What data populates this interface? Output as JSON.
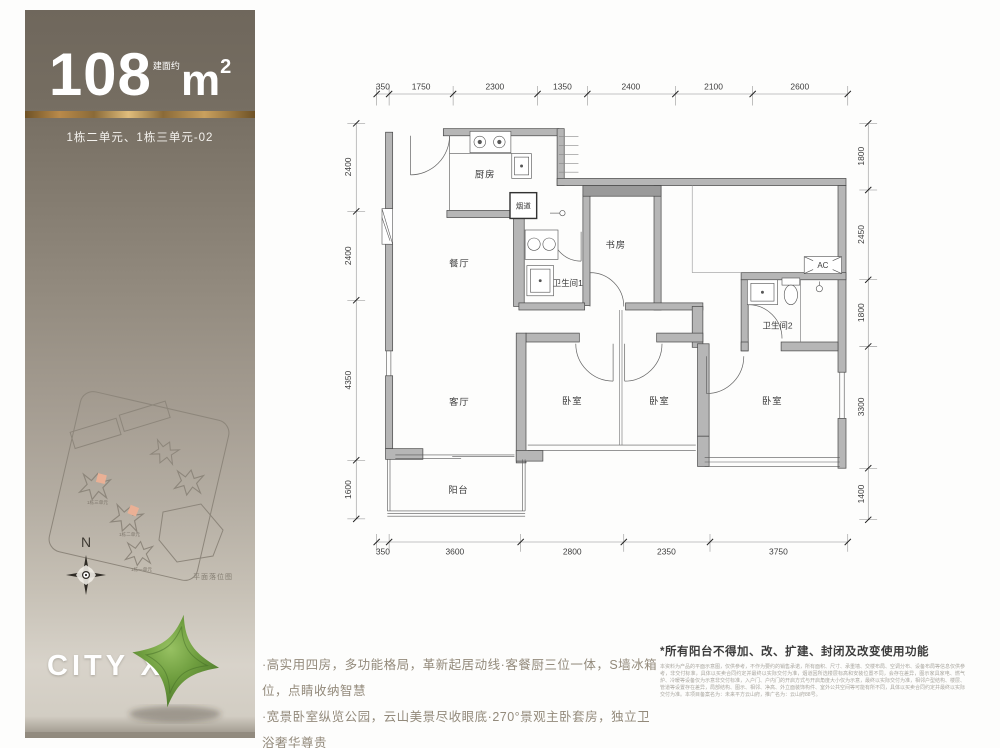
{
  "sidebar": {
    "area_value": "108",
    "area_prefix": "建面约",
    "area_unit": "m",
    "area_sup": "2",
    "unit_line": "1栋二单元、1栋三单元-02",
    "compass_label": "N",
    "siteplan_caption": "平面落位图",
    "siteplan_buildings": [
      "1栋三单元",
      "1栋二单元",
      "1栋一单元"
    ],
    "logo_text": "CITY X",
    "accent_gold": "#b98a4a",
    "logo_green": "#6f9e3f"
  },
  "floorplan": {
    "rooms": {
      "kitchen": "厨房",
      "flue": "烟道",
      "dining": "餐厅",
      "bath1": "卫生间1",
      "study": "书房",
      "ac": "AC",
      "bath2": "卫生间2",
      "living": "客厅",
      "bedroom1": "卧室",
      "bedroom2": "卧室",
      "bedroom3": "卧室",
      "balcony": "阳台"
    },
    "dims": {
      "top": [
        "350",
        "1750",
        "2300",
        "1350",
        "2400",
        "2100",
        "2600"
      ],
      "bottom": [
        "350",
        "3600",
        "2800",
        "2350",
        "3750"
      ],
      "left": [
        "2400",
        "2400",
        "4350",
        "1600"
      ],
      "right": [
        "1800",
        "2450",
        "1800",
        "3300",
        "1400"
      ]
    }
  },
  "footer": {
    "bullet1": "·高实用四房，多功能格局，革新起居动线·客餐厨三位一体，S墙冰箱位，点睛收纳智慧",
    "bullet2": "·宽景卧室纵览公园，云山美景尽收眼底·270°景观主卧套房，独立卫浴奢华尊贵",
    "disclaimer_title": "*所有阳台不得加、改、扩建、封闭及改变使用功能",
    "disclaimer_body": "本资料为产品的平面示意图，仅供参考，不作为要约的销售承诺，所有面积、尺寸、承重墙、交楼布局、空调分布、设备布局等信息仅供参考，非交付标准，具体以买卖合同约定并最终以实际交付为准，烟道因所选楼层标高和安装位置不同，会存在差异，图示家具家电、燃气炉、冷暖等设备仅为示意非交付标准，入户门、户内门的开启方式与开启角度大小仅为示意，最终以实际交付为准，相邻户型结构、楼层、管道等设置存在差异，局部结构、图示、相邻、净高、外立面装饰构件、室外公共空间等可能有所不同，具体以买卖合同约定并最终以实际交付为准。本项目备案名为：未来平方云山府，推广名为：云山府88号。"
  }
}
